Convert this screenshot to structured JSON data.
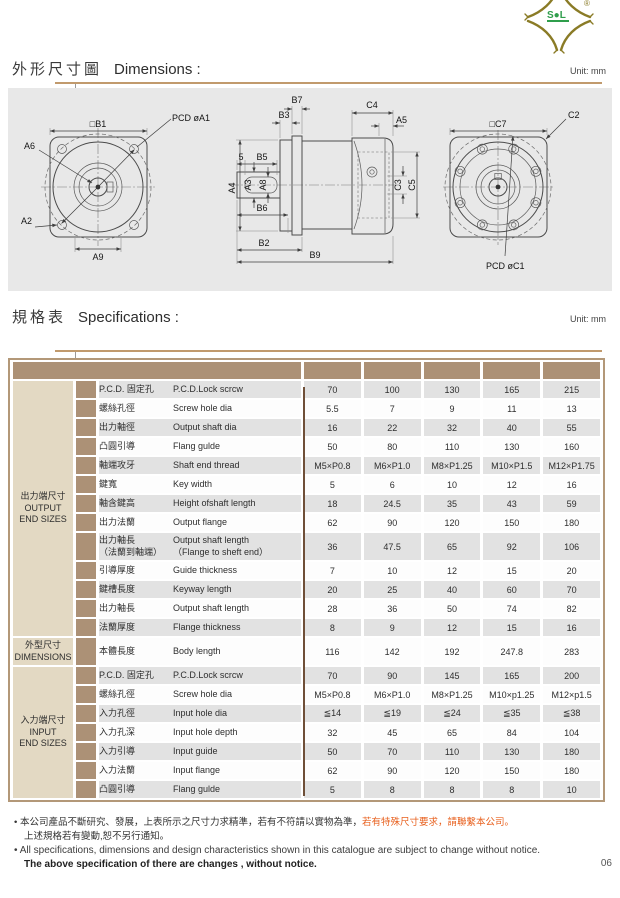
{
  "page": {
    "number": "06"
  },
  "logo": {
    "brand_text": "S●L",
    "registered_mark": "®",
    "color": "#8a7b26",
    "accent_green": "#2f9e4c"
  },
  "dimensions_section": {
    "title_zh": "外形尺寸圖",
    "title_en": "Dimensions :",
    "unit": "Unit: mm"
  },
  "specifications_section": {
    "title_zh": "規格表",
    "title_en": "Specifications :",
    "unit": "Unit: mm"
  },
  "drawing": {
    "labels": {
      "b1": "□B1",
      "pcd_a1": "PCD øA1",
      "a6": "A6",
      "a2": "A2",
      "a9": "A9",
      "b7": "B7",
      "b3": "B3",
      "n5": "5",
      "b5": "B5",
      "a4": "A4",
      "a3": "A3",
      "a8": "A8",
      "b6": "B6",
      "b2": "B2",
      "b9": "B9",
      "c4": "C4",
      "a5": "A5",
      "c3": "C3",
      "c5": "C5",
      "c7": "□C7",
      "c2": "C2",
      "pcd_c1": "PCD øC1"
    }
  },
  "table": {
    "colors": {
      "header_tan": "#ac9176",
      "group_beige": "#e3d9c3",
      "row_gray": "#e2e2e2",
      "divider_brown": "#6f4f38",
      "border_tan": "#b39878"
    },
    "groups": [
      {
        "zh": "出力端尺寸",
        "en": "OUTPUT\nEND SIZES",
        "rows": 13
      },
      {
        "zh": "外型尺寸",
        "en": "DIMENSIONS",
        "rows": 1
      },
      {
        "zh": "入力端尺寸",
        "en": "INPUT\nEND SIZES",
        "rows": 7
      }
    ],
    "rows": [
      {
        "zh": "P.C.D. 固定孔",
        "en": "P.C.D.Lock scrcw",
        "values": [
          "70",
          "100",
          "130",
          "165",
          "215"
        ]
      },
      {
        "zh": "螺絲孔徑",
        "en": "Screw hole dia",
        "values": [
          "5.5",
          "7",
          "9",
          "11",
          "13"
        ]
      },
      {
        "zh": "出力軸徑",
        "en": "Output shaft dia",
        "values": [
          "16",
          "22",
          "32",
          "40",
          "55"
        ]
      },
      {
        "zh": "凸圓引導",
        "en": "Flang gulde",
        "values": [
          "50",
          "80",
          "110",
          "130",
          "160"
        ]
      },
      {
        "zh": "軸端攻牙",
        "en": "Shaft end thread",
        "values": [
          "M5×P0.8",
          "M6×P1.0",
          "M8×P1.25",
          "M10×P1.5",
          "M12×P1.75"
        ]
      },
      {
        "zh": "鍵寬",
        "en": "Key width",
        "values": [
          "5",
          "6",
          "10",
          "12",
          "16"
        ]
      },
      {
        "zh": "軸含鍵高",
        "en": "Height ofshaft length",
        "values": [
          "18",
          "24.5",
          "35",
          "43",
          "59"
        ]
      },
      {
        "zh": "出力法蘭",
        "en": "Output flange",
        "values": [
          "62",
          "90",
          "120",
          "150",
          "180"
        ]
      },
      {
        "zh": "出力軸長\n（法蘭到軸端）",
        "en": "Output shaft length\n（Flange to sheft end）",
        "values": [
          "36",
          "47.5",
          "65",
          "92",
          "106"
        ],
        "tall": true
      },
      {
        "zh": "引導厚度",
        "en": "Guide thickness",
        "values": [
          "7",
          "10",
          "12",
          "15",
          "20"
        ]
      },
      {
        "zh": "鍵槽長度",
        "en": "Keyway length",
        "values": [
          "20",
          "25",
          "40",
          "60",
          "70"
        ]
      },
      {
        "zh": "出力軸長",
        "en": "Output shaft length",
        "values": [
          "28",
          "36",
          "50",
          "74",
          "82"
        ]
      },
      {
        "zh": "法蘭厚度",
        "en": "Flange thickness",
        "values": [
          "8",
          "9",
          "12",
          "15",
          "16"
        ]
      },
      {
        "zh": "本體長度",
        "en": "Body length",
        "values": [
          "116",
          "142",
          "192",
          "247.8",
          "283"
        ],
        "tall": true
      },
      {
        "zh": "P.C.D. 固定孔",
        "en": "P.C.D.Lock scrcw",
        "values": [
          "70",
          "90",
          "145",
          "165",
          "200"
        ]
      },
      {
        "zh": "螺絲孔徑",
        "en": "Screw hole dia",
        "values": [
          "M5×P0.8",
          "M6×P1.0",
          "M8×P1.25",
          "M10×p1.25",
          "M12×p1.5"
        ]
      },
      {
        "zh": "入力孔徑",
        "en": "Input hole dia",
        "values": [
          "≦14",
          "≦19",
          "≦24",
          "≦35",
          "≦38"
        ]
      },
      {
        "zh": "入力孔深",
        "en": "Input hole depth",
        "values": [
          "32",
          "45",
          "65",
          "84",
          "104"
        ]
      },
      {
        "zh": "入力引導",
        "en": "Input guide",
        "values": [
          "50",
          "70",
          "110",
          "130",
          "180"
        ]
      },
      {
        "zh": "入力法蘭",
        "en": "Input flange",
        "values": [
          "62",
          "90",
          "120",
          "150",
          "180"
        ]
      },
      {
        "zh": "凸圓引導",
        "en": "Flang gulde",
        "values": [
          "5",
          "8",
          "8",
          "8",
          "10"
        ]
      }
    ]
  },
  "footer": {
    "bullet": "•",
    "note1_zh": "本公司產品不斷研究、發展，上表所示之尺寸力求精準，若有不符請以實物為準，",
    "note1_zh_highlight": "若有特殊尺寸要求，請聯繫本公司。",
    "note2_zh": "上述規格若有變動,恕不另行通知。",
    "note3_en": "All specifications, dimensions and design characteristics shown in this catalogue are subject to change without notice.",
    "note4_en": "The above specification of there are changes , without notice.",
    "highlight_color": "#e8611f"
  }
}
